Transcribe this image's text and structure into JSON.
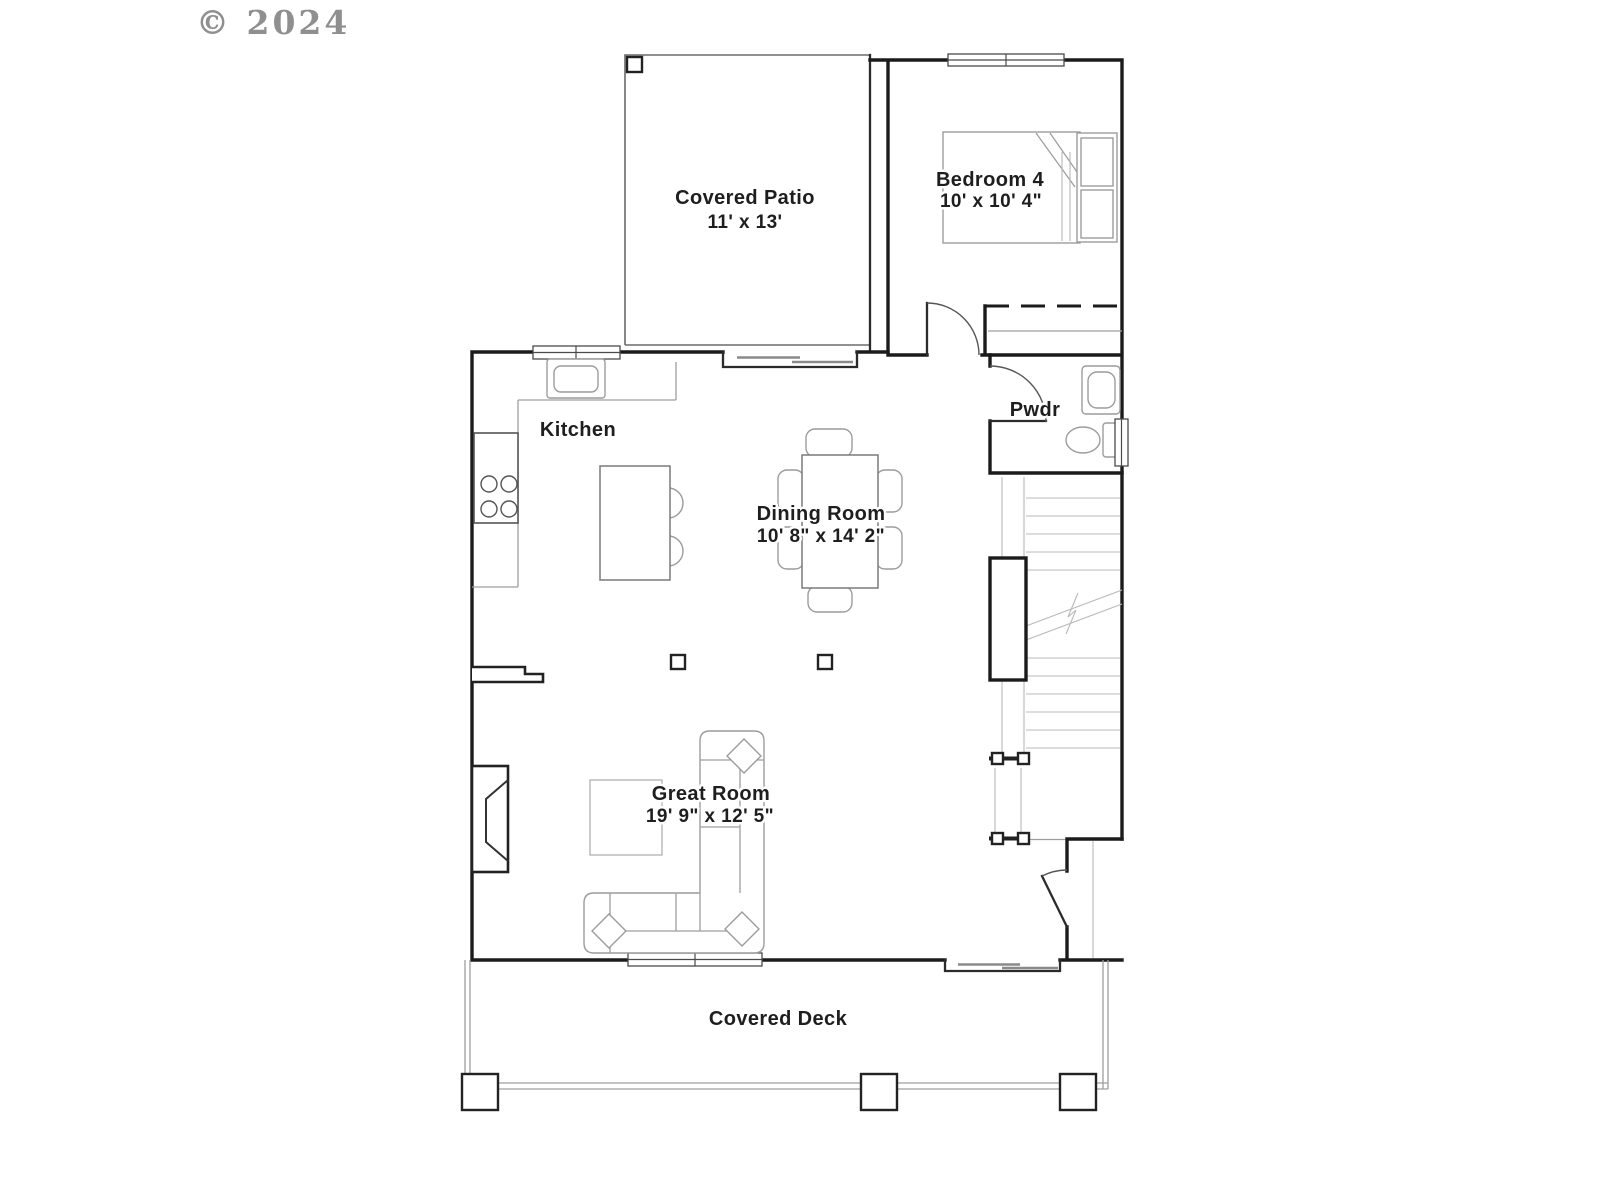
{
  "watermark": {
    "text": "© 2024"
  },
  "rooms": {
    "covered_patio": {
      "name": "Covered Patio",
      "dims": "11' x 13'"
    },
    "bedroom4": {
      "name": "Bedroom 4",
      "dims": "10' x 10' 4\""
    },
    "kitchen": {
      "name": "Kitchen"
    },
    "dining_room": {
      "name": "Dining Room",
      "dims": "10' 8\" x 14' 2\""
    },
    "powder_room": {
      "name": "Pwdr"
    },
    "great_room": {
      "name": "Great Room",
      "dims": "19' 9\" x 12' 5\""
    },
    "covered_deck": {
      "name": "Covered Deck"
    }
  },
  "colors": {
    "wall": "#1b1b1b",
    "furniture": "#9c9c9c",
    "text": "#1e1e1e",
    "watermark": "#8f8f8f",
    "background": "#ffffff"
  }
}
